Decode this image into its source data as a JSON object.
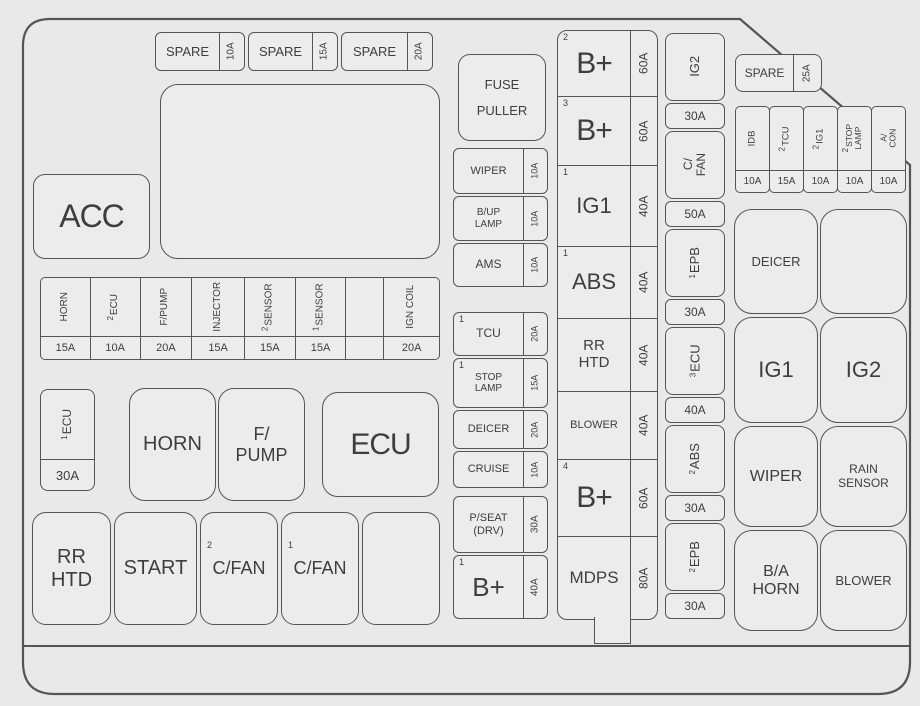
{
  "title": "Engine compartment fuse box diagram",
  "colors": {
    "background": "#e9e9e9",
    "box_fill": "#ececec",
    "line": "#555555",
    "text": "#3e3e3e"
  },
  "top_spare_row": [
    {
      "label": "SPARE",
      "amp": "10A"
    },
    {
      "label": "SPARE",
      "amp": "15A"
    },
    {
      "label": "SPARE",
      "amp": "20A"
    }
  ],
  "fuse_puller": {
    "label": "FUSE\nPULLER"
  },
  "acc": {
    "label": "ACC"
  },
  "left_fuse_row": [
    {
      "sup": "",
      "label": "HORN",
      "amp": "15A"
    },
    {
      "sup": "2",
      "label": "ECU",
      "amp": "10A"
    },
    {
      "sup": "",
      "label": "F/PUMP",
      "amp": "20A"
    },
    {
      "sup": "",
      "label": "INJECTOR",
      "amp": "15A"
    },
    {
      "sup": "2",
      "label": "SENSOR",
      "amp": "15A"
    },
    {
      "sup": "1",
      "label": "SENSOR",
      "amp": "15A"
    },
    {
      "sup": "",
      "label": "",
      "amp": ""
    },
    {
      "sup": "",
      "label": "IGN COIL",
      "amp": "20A"
    }
  ],
  "ecu_fuse": {
    "sup": "1",
    "label": "ECU",
    "amp": "30A"
  },
  "left_relays": [
    {
      "label": "HORN"
    },
    {
      "label": "F/\nPUMP"
    },
    {
      "label": "ECU"
    }
  ],
  "bottom_row": [
    {
      "sup": "",
      "label": "RR\nHTD"
    },
    {
      "sup": "",
      "label": "START"
    },
    {
      "sup": "2",
      "label": "C/FAN"
    },
    {
      "sup": "1",
      "label": "C/FAN"
    },
    {
      "sup": "",
      "label": ""
    }
  ],
  "mid_col1": [
    {
      "sup": "",
      "label": "WIPER",
      "amp": "10A"
    },
    {
      "sup": "",
      "label": "B/UP\nLAMP",
      "amp": "10A"
    },
    {
      "sup": "",
      "label": "AMS",
      "amp": "10A"
    },
    {
      "sup": "1",
      "label": "TCU",
      "amp": "20A"
    },
    {
      "sup": "1",
      "label": "STOP\nLAMP",
      "amp": "15A"
    },
    {
      "sup": "",
      "label": "DEICER",
      "amp": "20A"
    },
    {
      "sup": "",
      "label": "CRUISE",
      "amp": "10A"
    },
    {
      "sup": "",
      "label": "P/SEAT\n(DRV)",
      "amp": "30A"
    },
    {
      "sup": "1",
      "label": "B+",
      "amp": "40A"
    }
  ],
  "mid_col2": [
    {
      "sup": "2",
      "label": "B+",
      "amp": "60A"
    },
    {
      "sup": "3",
      "label": "B+",
      "amp": "60A"
    },
    {
      "sup": "1",
      "label": "IG1",
      "amp": "40A"
    },
    {
      "sup": "1",
      "label": "ABS",
      "amp": "40A"
    },
    {
      "sup": "",
      "label": "RR\nHTD",
      "amp": "40A"
    },
    {
      "sup": "",
      "label": "BLOWER",
      "amp": "40A"
    },
    {
      "sup": "4",
      "label": "B+",
      "amp": "60A"
    },
    {
      "sup": "",
      "label": "MDPS",
      "amp": "80A"
    }
  ],
  "mid_col3": [
    {
      "sup": "",
      "label": "IG2",
      "amp": "30A"
    },
    {
      "sup": "",
      "label": "C/\nFAN",
      "amp": "50A"
    },
    {
      "sup": "1",
      "label": "EPB",
      "amp": "30A"
    },
    {
      "sup": "3",
      "label": "ECU",
      "amp": "40A"
    },
    {
      "sup": "2",
      "label": "ABS",
      "amp": "30A"
    },
    {
      "sup": "2",
      "label": "EPB",
      "amp": "30A"
    }
  ],
  "right_spare": {
    "label": "SPARE",
    "amp": "25A"
  },
  "right_fuse_row": [
    {
      "sup": "",
      "label": "IDB",
      "amp": "10A"
    },
    {
      "sup": "2",
      "label": "TCU",
      "amp": "15A"
    },
    {
      "sup": "2",
      "label": "IG1",
      "amp": "10A"
    },
    {
      "sup": "2",
      "label": "STOP\nLAMP",
      "amp": "10A"
    },
    {
      "sup": "",
      "label": "A/\nCON",
      "amp": "10A"
    }
  ],
  "right_relays": [
    {
      "label": "DEICER"
    },
    {
      "label": ""
    },
    {
      "label": "IG1"
    },
    {
      "label": "IG2"
    },
    {
      "label": "WIPER"
    },
    {
      "label": "RAIN\nSENSOR"
    },
    {
      "label": "B/A\nHORN"
    },
    {
      "label": "BLOWER"
    }
  ]
}
